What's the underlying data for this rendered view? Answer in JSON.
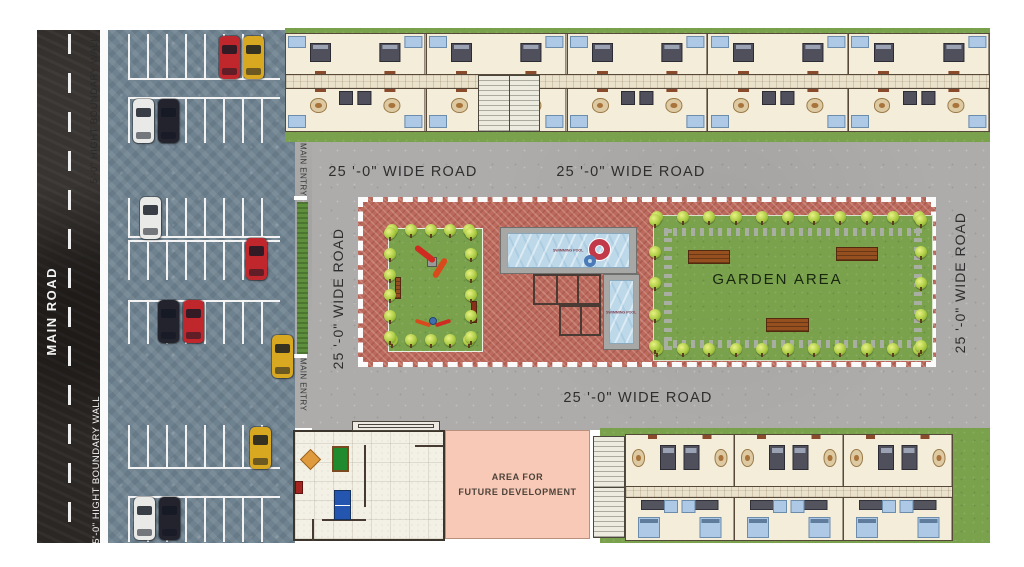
{
  "labels": {
    "main_road": "MAIN ROAD",
    "boundary_wall_top": "5'-0\" HIGHT BOUNDARY WALL",
    "boundary_wall_bottom": "5'-0\" HIGHT BOUNDARY WALL",
    "main_entry_top": "MAIN ENTRY",
    "main_entry_bottom": "MAIN ENTRY",
    "wide_road_top_left": "25 '-0\" WIDE ROAD",
    "wide_road_top_right": "25 '-0\" WIDE ROAD",
    "wide_road_bottom": "25 '-0\" WIDE ROAD",
    "wide_road_left": "25 '-0\" WIDE ROAD",
    "wide_road_right": "25 '-0\" WIDE ROAD",
    "garden_area": "GARDEN AREA",
    "swimming_pool_main": "SWIMMING POOL",
    "swimming_pool_small": "SWIMMING POOL",
    "future_area_line1": "AREA FOR",
    "future_area_line2": "FUTURE DEVELOPMENT"
  },
  "car_colors": {
    "red": "#c0272d",
    "yellow": "#d9a821",
    "black": "#23232e",
    "white": "#e9e9e7"
  },
  "cars": [
    {
      "color": "red",
      "x": 219,
      "y": 36,
      "w": 21,
      "h": 43
    },
    {
      "color": "yellow",
      "x": 243,
      "y": 36,
      "w": 21,
      "h": 43
    },
    {
      "color": "white",
      "x": 133,
      "y": 99,
      "w": 21,
      "h": 44
    },
    {
      "color": "black",
      "x": 158,
      "y": 99,
      "w": 21,
      "h": 44
    },
    {
      "color": "white",
      "x": 140,
      "y": 197,
      "w": 21,
      "h": 42
    },
    {
      "color": "red",
      "x": 246,
      "y": 238,
      "w": 21,
      "h": 42
    },
    {
      "color": "black",
      "x": 158,
      "y": 300,
      "w": 21,
      "h": 43
    },
    {
      "color": "red",
      "x": 183,
      "y": 300,
      "w": 21,
      "h": 43
    },
    {
      "color": "yellow",
      "x": 272,
      "y": 335,
      "w": 21,
      "h": 43
    },
    {
      "color": "yellow",
      "x": 250,
      "y": 427,
      "w": 21,
      "h": 42
    },
    {
      "color": "white",
      "x": 134,
      "y": 497,
      "w": 21,
      "h": 43
    },
    {
      "color": "black",
      "x": 159,
      "y": 497,
      "w": 21,
      "h": 43
    }
  ],
  "parking_rows": [
    {
      "x": 128,
      "y": 34,
      "w": 152,
      "h": 46,
      "edge": "bottom"
    },
    {
      "x": 128,
      "y": 97,
      "w": 152,
      "h": 46,
      "edge": "top"
    },
    {
      "x": 128,
      "y": 198,
      "w": 152,
      "h": 40,
      "edge": "bottom"
    },
    {
      "x": 128,
      "y": 240,
      "w": 152,
      "h": 40,
      "edge": "top"
    },
    {
      "x": 128,
      "y": 300,
      "w": 152,
      "h": 44,
      "edge": "top"
    },
    {
      "x": 128,
      "y": 425,
      "w": 152,
      "h": 44,
      "edge": "bottom"
    },
    {
      "x": 128,
      "y": 496,
      "w": 152,
      "h": 46,
      "edge": "top"
    }
  ],
  "housing": {
    "top_block": {
      "units_top_row": 10,
      "units_bottom_row": 10
    },
    "bottom_block": {
      "units_top_row": 6,
      "units_bottom_row": 6
    }
  },
  "trees": {
    "playground": {
      "top": 5,
      "bottom": 5,
      "left": 6,
      "right": 6
    },
    "garden": {
      "top": 11,
      "bottom": 11,
      "left": 5,
      "right": 5
    }
  },
  "garden_benches": [
    {
      "x": 688,
      "y": 250,
      "w": 42,
      "h": 14
    },
    {
      "x": 836,
      "y": 247,
      "w": 42,
      "h": 14
    },
    {
      "x": 766,
      "y": 318,
      "w": 43,
      "h": 14
    }
  ]
}
